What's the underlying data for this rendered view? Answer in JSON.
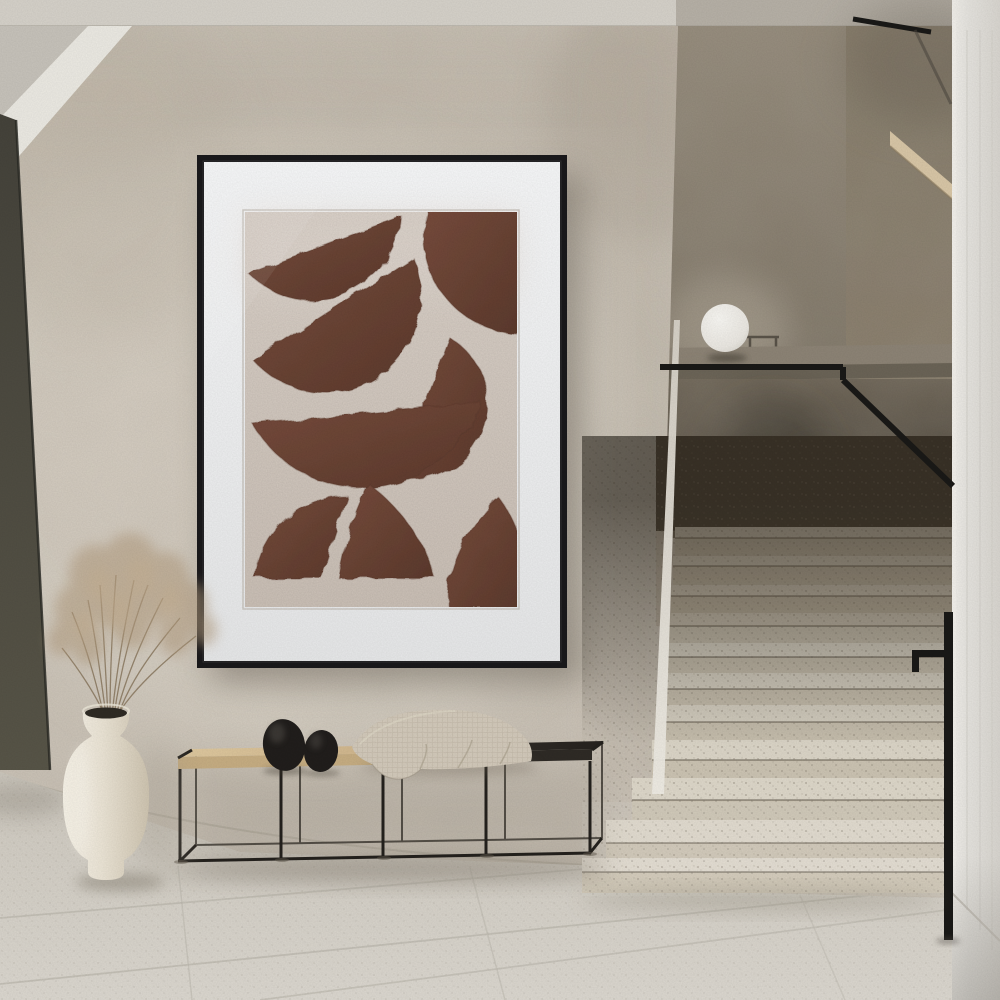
{
  "scene": {
    "type": "interior photograph",
    "description": "Minimalist hallway: framed abstract art above a low bench with two stones and a folded throw, a cream vase with dried pampas grass, and a terrazzo staircase with black handrail and sphere lamp"
  },
  "palette": {
    "wall": "#cdc5b9",
    "wall_light": "#dcd5c9",
    "wall_dark": "#b4ab9d",
    "ceiling": "#d6d2ca",
    "ceiling_stair": "#b7b1a7",
    "soffit_grey": "#c7c3bb",
    "soffit_bright": "#eceae3",
    "door": "#4a4840",
    "door_edge": "#2c2b26",
    "stair_wall_top": "#968c7c",
    "stair_wall_low": "#6f675b",
    "upper_right_wall": "#8a7f6e",
    "ledge": "#8d8476",
    "ledge_front": "#6b6457",
    "balustrade_top": "#6e6557",
    "balustrade_low": "#423d34",
    "rail": "#1a1917",
    "step_dark_zone": "#3f3930",
    "step_tread": "#d8d2c4",
    "step_riser": "#c8c0af",
    "column": "#e5e3de",
    "column_edge": "#f2f0eb",
    "floor": "#d8d3ca",
    "grout": "#c0bcb2",
    "frame": "#1a191b",
    "mat": "#f3f4f5",
    "art_bg": "#d8cdc4",
    "art_shape": "#714737",
    "art_shape_edge": "#5a392c",
    "wood": "#d8c096",
    "wood_front": "#c7ae83",
    "dark_wood": "#2f2b26",
    "metal": "#24211d",
    "stone": "#211e1c",
    "blanket": "#d3cabb",
    "blanket_shade": "#6d6355",
    "vase": "#efe9dc",
    "vase_mouth": "#2f2b24",
    "plume": "#b29b7e",
    "plume_light": "#c6b092",
    "stem": "#806d52",
    "lamp": "#f1efe9",
    "shadow": "#6b6458",
    "wood_soffit": "#d9c7a7"
  },
  "artwork": {
    "style": "abstract watercolor half-circles and wedges",
    "shape_count": 8
  },
  "staircase": {
    "visible_steps": 11
  },
  "bench": {
    "stone_count": 2
  }
}
